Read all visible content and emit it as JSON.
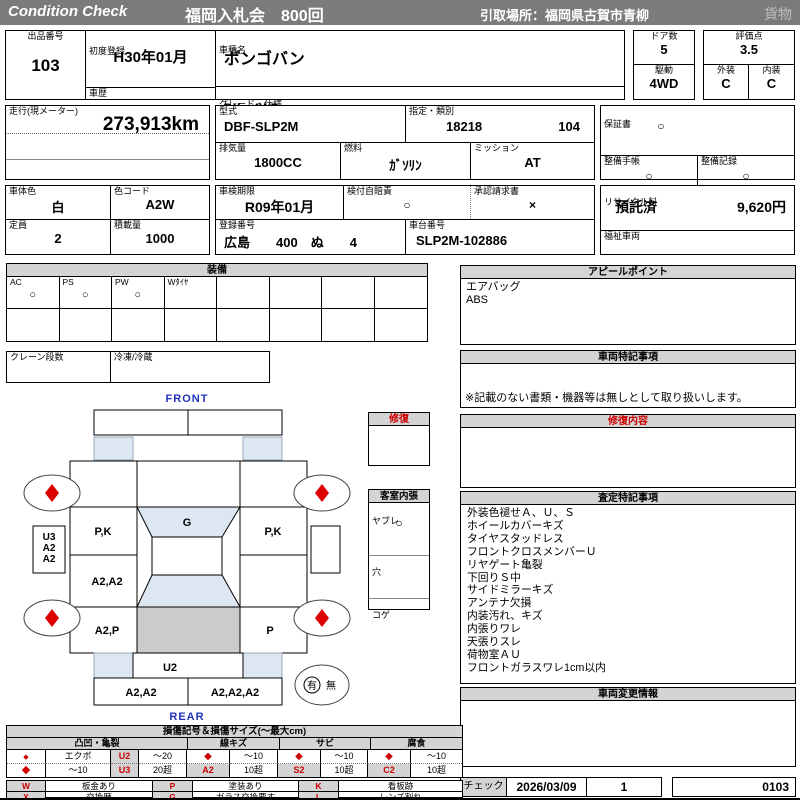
{
  "header": {
    "brand": "Condition  Check",
    "auction_title": "福岡入札会　800回",
    "pickup_location": "引取場所：福岡県古賀市青柳",
    "category": "貨物"
  },
  "lot": {
    "number_label": "出品番号",
    "number": "103",
    "first_registration_label": "初度登録",
    "first_registration": "H30年01月",
    "history_label": "車歴",
    "history": "",
    "model_name_label": "車種名",
    "model_name": "ボンゴバン",
    "grade_label": "グレード・仕様",
    "grade": "DX　4WD",
    "doors_label": "ドア数",
    "doors": "5",
    "drive_label": "駆動",
    "drive": "4WD",
    "score_label": "評価点",
    "score": "3.5",
    "exterior_label": "外装",
    "exterior_grade": "C",
    "interior_label": "内装",
    "interior_grade": "C"
  },
  "spec": {
    "odometer_label": "走行(現メーター)",
    "odometer": "273,913km",
    "model_code_label": "型式",
    "model_code": "DBF-SLP2M",
    "designation_label": "指定・類別",
    "designation_no": "18218",
    "class_no": "104",
    "displacement_label": "排気量",
    "displacement": "1800CC",
    "fuel_label": "燃料",
    "fuel": "ｶﾞｿﾘﾝ",
    "mission_label": "ミッション",
    "mission": "AT",
    "warranty_label": "保証書",
    "warranty_mark": "○",
    "service_book_label": "整備手帳",
    "service_book_mark": "○",
    "service_record_label": "整備記録",
    "service_record_mark": "○"
  },
  "registration": {
    "body_color_label": "車体色",
    "body_color": "白",
    "color_code_label": "色コード",
    "color_code": "A2W",
    "capacity_label": "定員",
    "capacity": "2",
    "payload_label": "積載量",
    "payload": "1000",
    "inspection_label": "車検期限",
    "inspection_until": "R09年01月",
    "insurance_label": "検付自賠責",
    "insurance_mark": "○",
    "approval_label": "承認請求書",
    "approval_mark": "×",
    "plate_label": "登録番号",
    "plate": "広島　　400　ぬ　　4",
    "vin_label": "車台番号",
    "vin": "SLP2M-102886",
    "recycle_label": "リサイクル料",
    "recycle_status": "預託済",
    "recycle_fee": "9,620円",
    "welfare_label": "福祉車両"
  },
  "equipment": {
    "title": "装備",
    "items": [
      {
        "label": "AC",
        "mark": "○"
      },
      {
        "label": "PS",
        "mark": "○"
      },
      {
        "label": "PW",
        "mark": "○"
      },
      {
        "label": "Wﾀｲﾔ",
        "mark": ""
      },
      {
        "label": "",
        "mark": ""
      },
      {
        "label": "",
        "mark": ""
      },
      {
        "label": "",
        "mark": ""
      },
      {
        "label": "",
        "mark": ""
      }
    ],
    "crane_label": "クレーン段数",
    "refrigeration_label": "冷凍/冷蔵"
  },
  "appeal": {
    "title": "アピールポイント",
    "lines": [
      "エアバッグ",
      "ABS"
    ]
  },
  "vehicle_notes": {
    "title": "車両特記事項",
    "disclaimer": "※記載のない書類・機器等は無しとして取り扱いします。"
  },
  "repair_content": {
    "title": "修復内容"
  },
  "assessment": {
    "title": "査定特記事項",
    "lines": [
      "外装色褪せＡ、Ｕ、Ｓ",
      "ホイールカバーキズ",
      "タイヤスタッドレス",
      "フロントクロスメンバーＵ",
      "リヤゲート亀裂",
      "下回りＳ中",
      "サイドミラーキズ",
      "アンテナ欠損",
      "内装汚れ、キズ",
      "内張りワレ",
      "天張りスレ",
      "荷物室ＡＵ",
      "フロントガラスワレ1cm以内"
    ]
  },
  "change_info": {
    "title": "車両変更情報"
  },
  "diagram": {
    "front_label": "FRONT",
    "rear_label": "REAR",
    "repair_box_title": "修復",
    "cabin_title": "客室内張",
    "cabin_rows": [
      {
        "label": "ヤブレ",
        "mark": "○"
      },
      {
        "label": "穴",
        "mark": ""
      },
      {
        "label": "コゲ",
        "mark": ""
      }
    ],
    "marks": {
      "front_left_door": "P,K",
      "windshield": "G",
      "front_right_door": "P,K",
      "left_center_panel": "A2,A2",
      "left_rear_panel": "A2,P",
      "right_rear_panel": "P",
      "left_side_notes": [
        "U3",
        "A2",
        "A2"
      ],
      "rear_gate": "U2",
      "rear_bumper_left": "A2,A2",
      "rear_bumper_right": "A2,A2,A2"
    },
    "spare_tire": {
      "present": "有",
      "absent": "無"
    }
  },
  "damage_legend": {
    "title": "損傷記号＆損傷サイズ(〜最大cm)",
    "groups": [
      "凸凹・亀裂",
      "線キズ",
      "サビ",
      "腐食"
    ],
    "diamond": "◆",
    "dent": {
      "sym1_desc": "エクボ",
      "code1": "U2",
      "size1": "〜20",
      "sym2_desc": "〜10",
      "code2": "U3",
      "size2": "20超"
    },
    "scratch": {
      "size1": "〜10",
      "code": "A2",
      "size2": "10超"
    },
    "rust": {
      "size1": "〜10",
      "code": "S2",
      "size2": "10超"
    },
    "corrosion": {
      "size1": "〜10",
      "code": "C2",
      "size2": "10超"
    },
    "symbols": [
      {
        "code": "W",
        "desc": "板金あり"
      },
      {
        "code": "P",
        "desc": "塗装あり"
      },
      {
        "code": "K",
        "desc": "看板跡"
      },
      {
        "code": "X",
        "desc": "交換歴"
      },
      {
        "code": "G",
        "desc": "ガラス交換要す"
      },
      {
        "code": "L",
        "desc": "レンズ割れ"
      }
    ]
  },
  "check": {
    "label": "チェック",
    "date": "2026/03/09",
    "count": "1",
    "code": "0103"
  },
  "colors": {
    "bar_gray": "#7b7b7b",
    "panel_gray": "#d4d4d4",
    "accent_blue": "#2233bb",
    "mark_red": "#cc0000",
    "light_blue": "#dce7f2",
    "shade_gray": "#cbcbcb"
  }
}
